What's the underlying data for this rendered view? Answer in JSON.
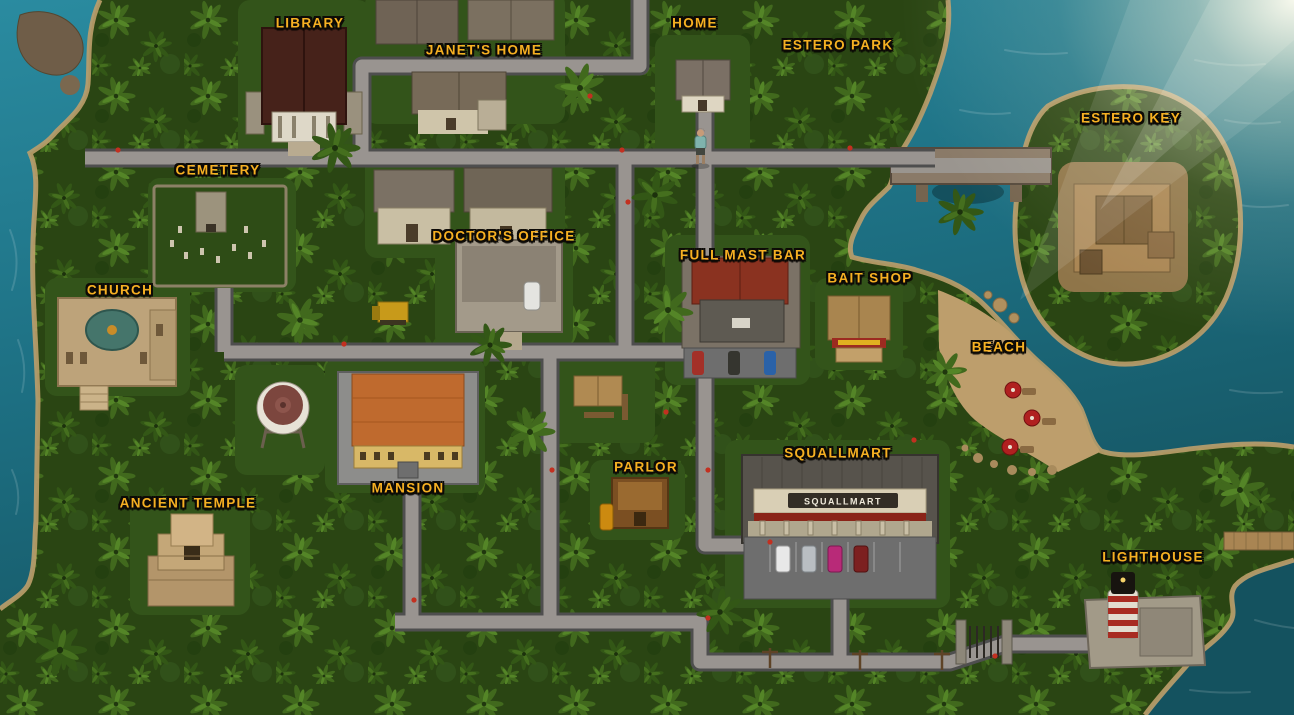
{
  "view": "island-town-map",
  "locations": [
    {
      "id": "library",
      "label": "Library"
    },
    {
      "id": "janets-home",
      "label": "Janet's Home"
    },
    {
      "id": "home",
      "label": "Home"
    },
    {
      "id": "estero-park",
      "label": "Estero Park"
    },
    {
      "id": "estero-key",
      "label": "Estero Key"
    },
    {
      "id": "cemetery",
      "label": "Cemetery"
    },
    {
      "id": "doctors-office",
      "label": "Doctor's Office"
    },
    {
      "id": "full-mast-bar",
      "label": "Full Mast Bar"
    },
    {
      "id": "bait-shop",
      "label": "Bait Shop"
    },
    {
      "id": "church",
      "label": "Church"
    },
    {
      "id": "beach",
      "label": "Beach"
    },
    {
      "id": "mansion",
      "label": "Mansion"
    },
    {
      "id": "ancient-temple",
      "label": "Ancient Temple"
    },
    {
      "id": "parlor",
      "label": "Parlor"
    },
    {
      "id": "squallmart",
      "label": "Squallmart"
    },
    {
      "id": "lighthouse",
      "label": "Lighthouse"
    }
  ],
  "signs": {
    "squallmart_storefront": "SQUALLMART"
  },
  "colors": {
    "label_gold": "#f6b022",
    "label_outline": "#0d0a06",
    "water": "#1d6f82",
    "jungle": "#2a4513",
    "road": "#999490",
    "sand": "#bc9e6b",
    "umbrella_red": "#b02020"
  }
}
